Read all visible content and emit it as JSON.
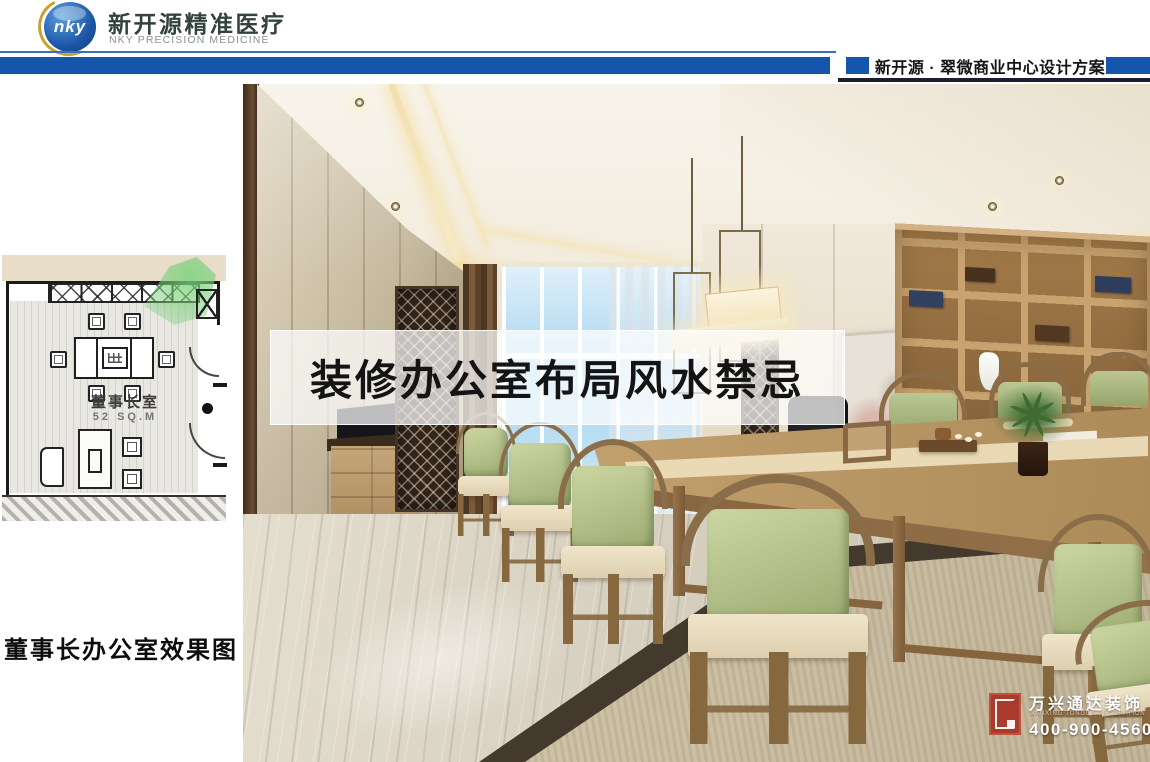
{
  "brand": {
    "logo_text": "nky",
    "name_cn": "新开源精准医疗",
    "name_en": "NKY PRECISION MEDICINE"
  },
  "header": {
    "project_title": "新开源 · 翠微商业中心设计方案"
  },
  "floor_plan": {
    "room_label": "董事长室",
    "area_label": "52 SQ.M"
  },
  "caption": {
    "text": "董事长办公室效果图"
  },
  "overlay": {
    "title": "装修办公室布局风水禁忌"
  },
  "watermark": {
    "company_cn": "万兴通达装饰",
    "company_en": "WANXING TONGDA DECORATION",
    "phone": "400-900-4560"
  },
  "colors": {
    "brand_blue": "#1356ab",
    "brand_gold": "#c9a22b",
    "header_rule_dark": "#1c1d30",
    "plan_camera_green": "#6cc06c",
    "watermark_red": "#a93b2c"
  }
}
